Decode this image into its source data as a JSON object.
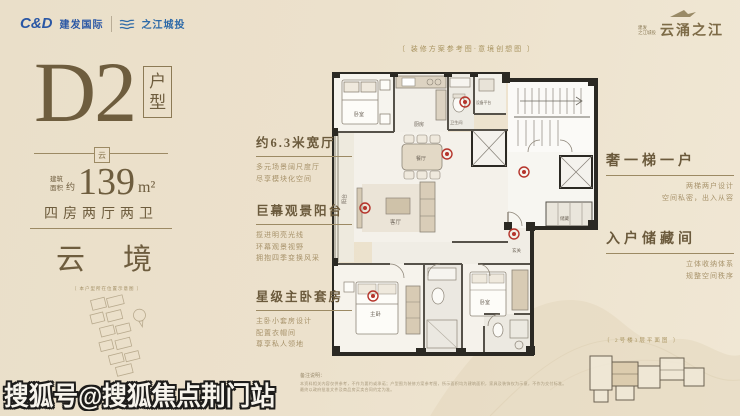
{
  "header": {
    "cd_logo": "C&D",
    "cd_name": "建发国际",
    "partner_name": "之江城投",
    "project_small_top": "建发",
    "project_small_bottom": "之江城投",
    "project_name": "云涌之江"
  },
  "unit_panel": {
    "code": "D2",
    "tag_char_1": "户",
    "tag_char_2": "型",
    "ornament": "云",
    "area_prefix_1": "建筑",
    "area_prefix_2": "面积",
    "area_approx": "约",
    "area_value": "139",
    "area_unit": "m²",
    "layout_text": "四房两厅两卫",
    "theme_char_1": "云",
    "theme_char_2": "境",
    "location_caption": "〔 本户型所在位置示意图 〕"
  },
  "plan_caption": "〔 装修方案参考图·意境创想图 〕",
  "features_left": [
    {
      "title": "约6.3米宽厅",
      "lines": [
        "多元场景阔尺度厅",
        "尽享模块化空间"
      ]
    },
    {
      "title": "巨幕观景阳台",
      "lines": [
        "揽进明亮光线",
        "环幕观景视野",
        "拥抱四季变换风采"
      ]
    },
    {
      "title": "星级主卧套房",
      "lines": [
        "主卧小套房设计",
        "配置衣帽间",
        "尊享私人领地"
      ]
    }
  ],
  "features_right": [
    {
      "title": "奢一梯一户",
      "lines": [
        "两梯两户设计",
        "空间私密，出入从容"
      ]
    },
    {
      "title": "入户储藏间",
      "lines": [
        "立体收纳体系",
        "规整空间秩序"
      ]
    }
  ],
  "floor_plan": {
    "room_labels": [
      "阳台",
      "客厅",
      "餐厅",
      "厨房",
      "卫生间",
      "设备平台",
      "主卧",
      "卧室",
      "玄关",
      "储藏"
    ]
  },
  "keyplan_caption": "〔 2号楼3层平面图 〕",
  "disclaimer": {
    "note_label": "备注说明：",
    "line_1": "本资料相关内容仅供参考，不作为要约或承诺；户型图为装修方案参考图，所示面积均为建筑面积，家具及装饰仅为示意，不作为交付标准。",
    "line_2": "最终以政府批准文件及商品房买卖合同约定为准。"
  },
  "watermark": "搜狐号@搜狐焦点荆门站",
  "colors": {
    "background": "#ece1cc",
    "ink_brown": "#6b5a3c",
    "gold": "#a8935f",
    "cd_blue": "#2a57a5",
    "hotspot_red": "#b5342b",
    "wall_black": "#2b2923"
  }
}
